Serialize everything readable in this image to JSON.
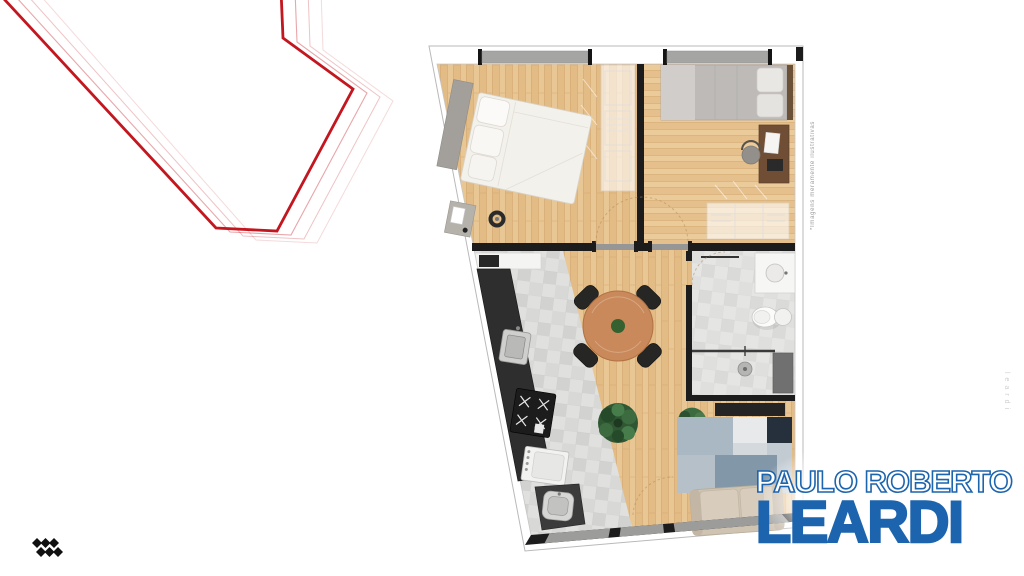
{
  "page": {
    "background": "#ffffff"
  },
  "red_line_art": {
    "stroke_color": "#c3161f",
    "echo_opacity": [
      0.38,
      0.26,
      0.16
    ]
  },
  "floor_plan": {
    "disclaimer_vertical_text": "*Imagens meramente ilustrativas",
    "wall_color": "#1c1c1c",
    "window_color": "#a5a5a3",
    "wood_floor_color": "#e8c априори592",
    "tile_floor_color": "#dcdcda"
  },
  "watermark": {
    "vertical_text": "leardi"
  },
  "branding": {
    "line1": "PAULO ROBERTO",
    "line2": "LEARDI",
    "color": "#1d64ae",
    "mark_icon": "diamond-cluster-icon",
    "mark_color": "#111111"
  }
}
